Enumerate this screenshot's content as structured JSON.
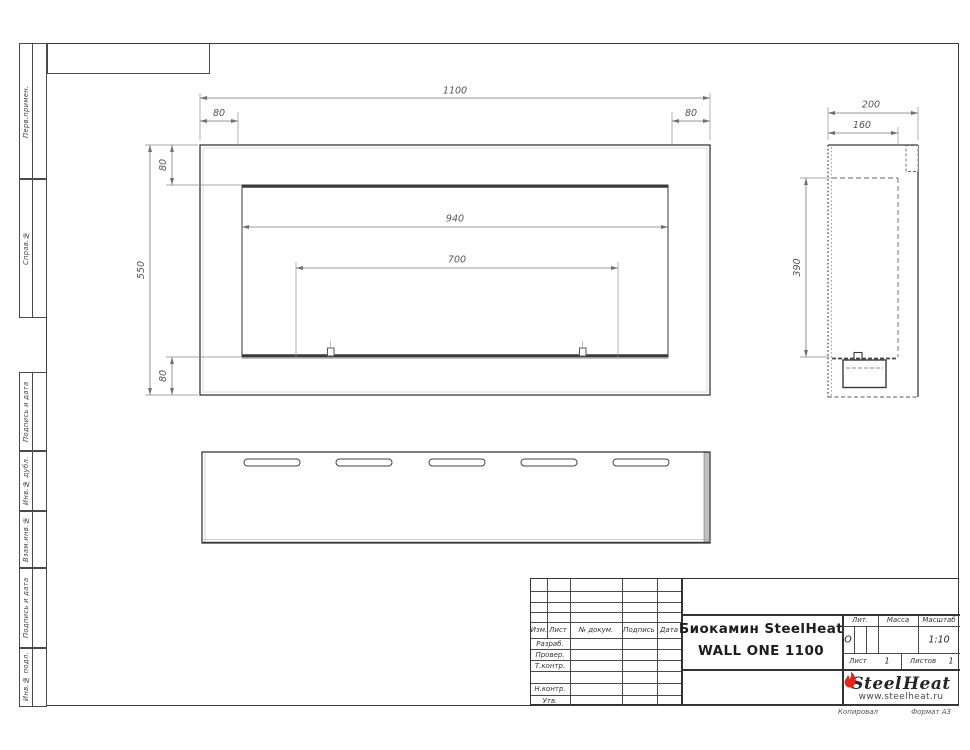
{
  "document": {
    "footer": {
      "copied": "Копировал",
      "format": "Формат А3"
    }
  },
  "sidebar": {
    "cells": [
      {
        "label": "Перв.примен."
      },
      {
        "label": "Справ.№"
      },
      {
        "label": "Подпись и дата"
      },
      {
        "label": "Инв.№ дубл."
      },
      {
        "label": "Взам.инв.№"
      },
      {
        "label": "Подпись и дата"
      },
      {
        "label": "Инв.№ подл."
      }
    ]
  },
  "title_block": {
    "change_header": {
      "izm": "Изм.",
      "list": "Лист",
      "doc": "№ докум.",
      "sign": "Подпись",
      "date": "Дата"
    },
    "role_labels": {
      "developed": "Разраб.",
      "checked": "Провер.",
      "tcontrol": "Т.контр.",
      "ncontrol": "Н.контр.",
      "approved": "Утв."
    },
    "title_line1": "Биокамин SteelHeat",
    "title_line2": "WALL ONE 1100",
    "lit_label": "Лит.",
    "lit_value": "О",
    "mass_label": "Масса",
    "scale_label": "Масштаб",
    "scale_value": "1:10",
    "sheet_label": "Лист",
    "sheet_number": "1",
    "sheets_label": "Листов",
    "sheets_total": "1",
    "logo": {
      "word1": "Steel",
      "word2": "Heat",
      "website": "www.steelheat.ru",
      "flame_color": "#e2261c"
    }
  },
  "views": {
    "front": {
      "dims": {
        "overall_width": "1100",
        "flange_left": "80",
        "flange_right": "80",
        "flange_top": "80",
        "overall_height": "550",
        "flange_bottom": "80",
        "opening_width": "940",
        "mount_span": "700"
      }
    },
    "side": {
      "dims": {
        "overall_depth": "200",
        "body_depth": "160",
        "opening_height": "390"
      }
    },
    "bottom": {
      "slot_count": 5
    }
  }
}
